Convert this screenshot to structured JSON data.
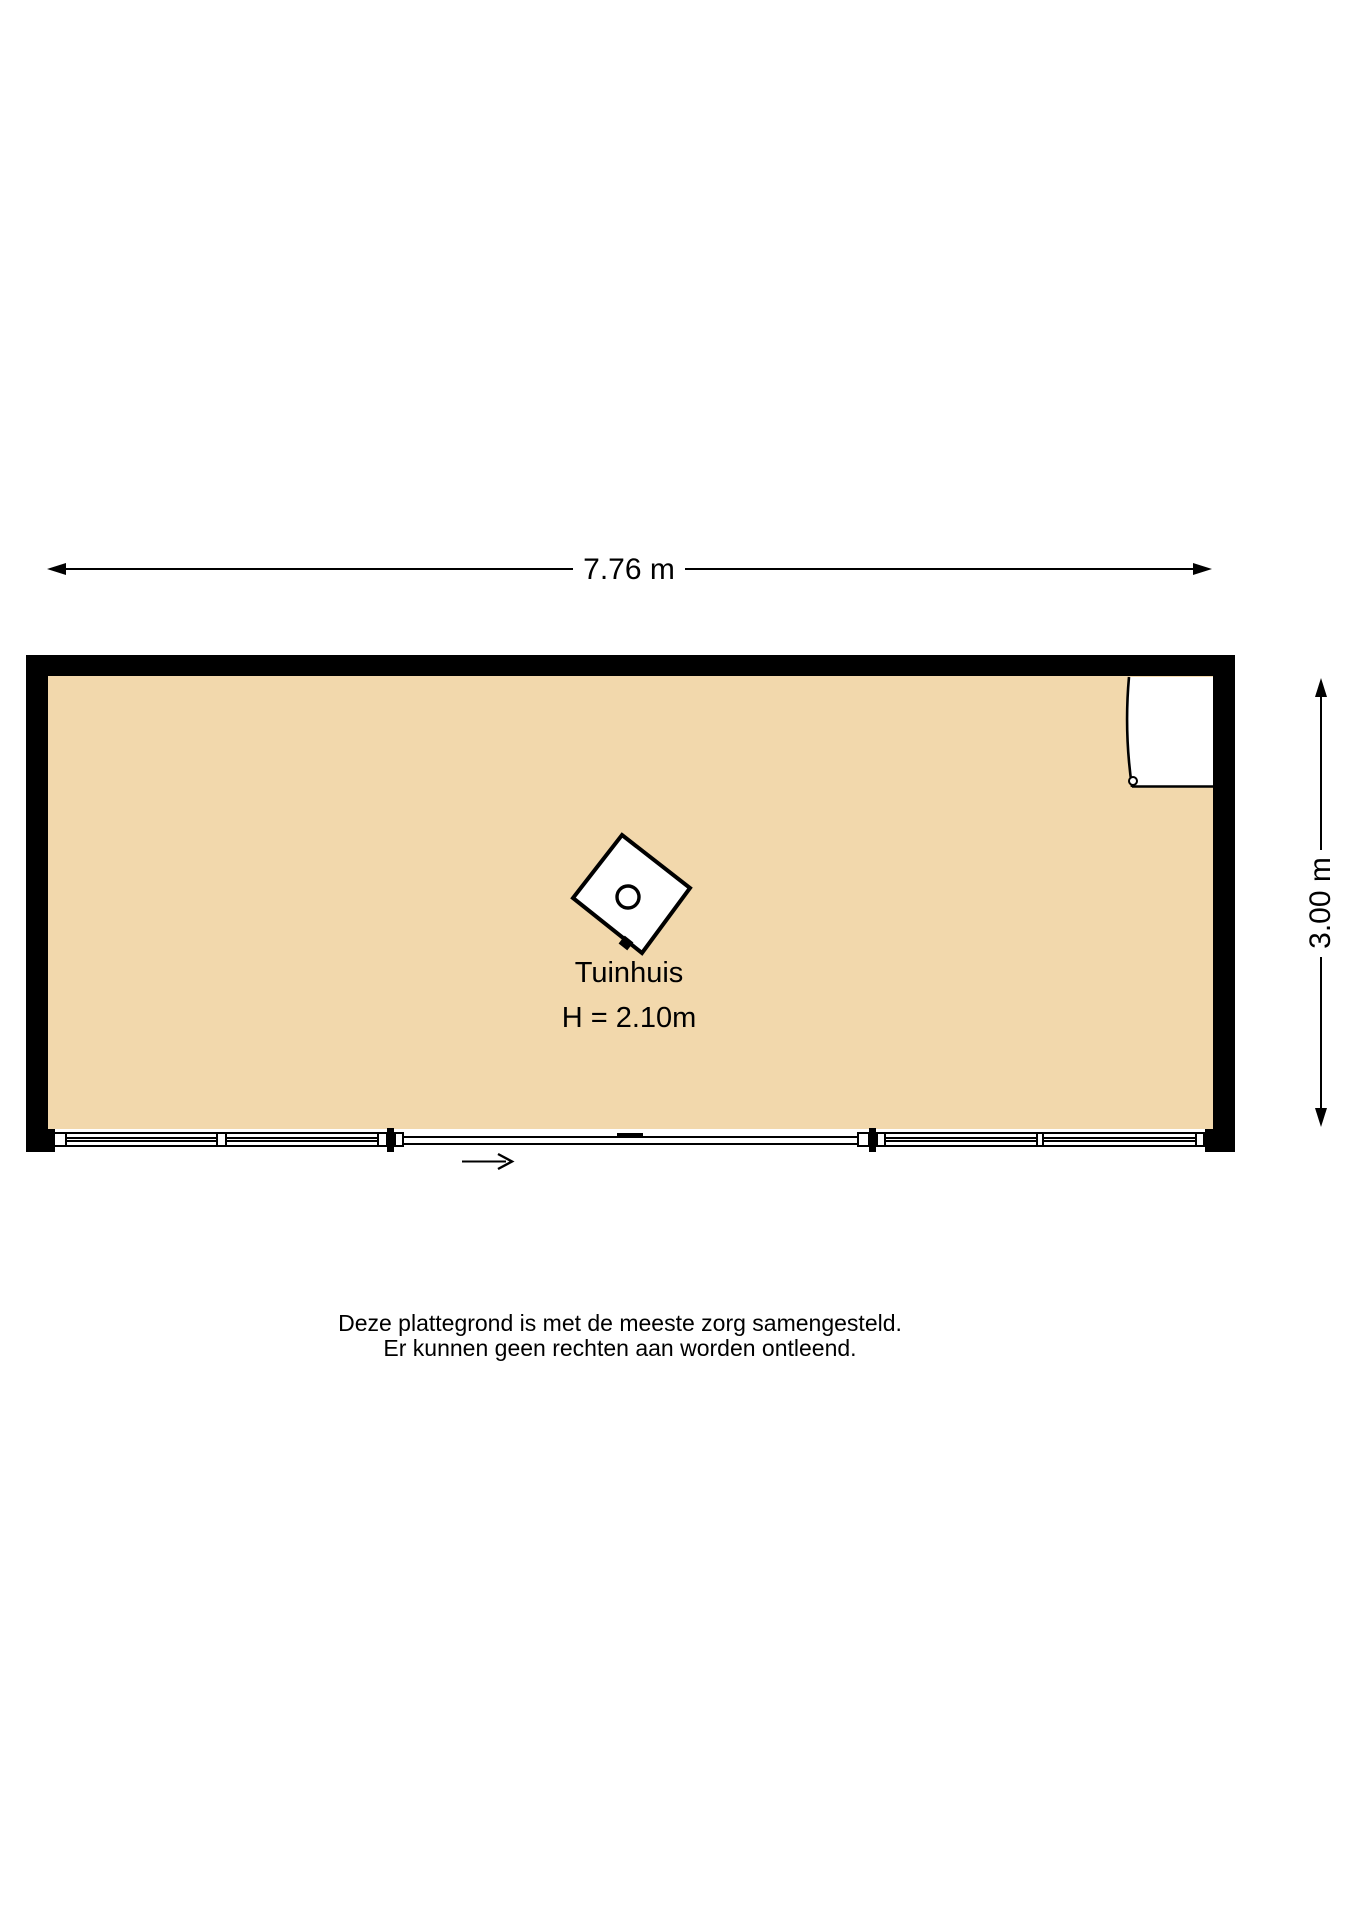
{
  "dimensions": {
    "width": "7.76 m",
    "depth": "3.00 m"
  },
  "room": {
    "name": "Tuinhuis",
    "ceiling_height": "H = 2.10m"
  },
  "disclaimer": {
    "line1": "Deze plattegrond is met de meeste zorg samengesteld.",
    "line2": "Er kunnen geen rechten aan worden ontleend."
  },
  "icons": {
    "stove": "stove-icon",
    "door": "door-swing-icon",
    "sliding_door": "sliding-door-icon",
    "window": "window-glazing-icon",
    "direction_arrow": "slide-direction-arrow-icon"
  },
  "colors": {
    "floor_fill": "#f2d8ac",
    "wall": "#000000",
    "line": "#000000",
    "background": "#ffffff"
  }
}
